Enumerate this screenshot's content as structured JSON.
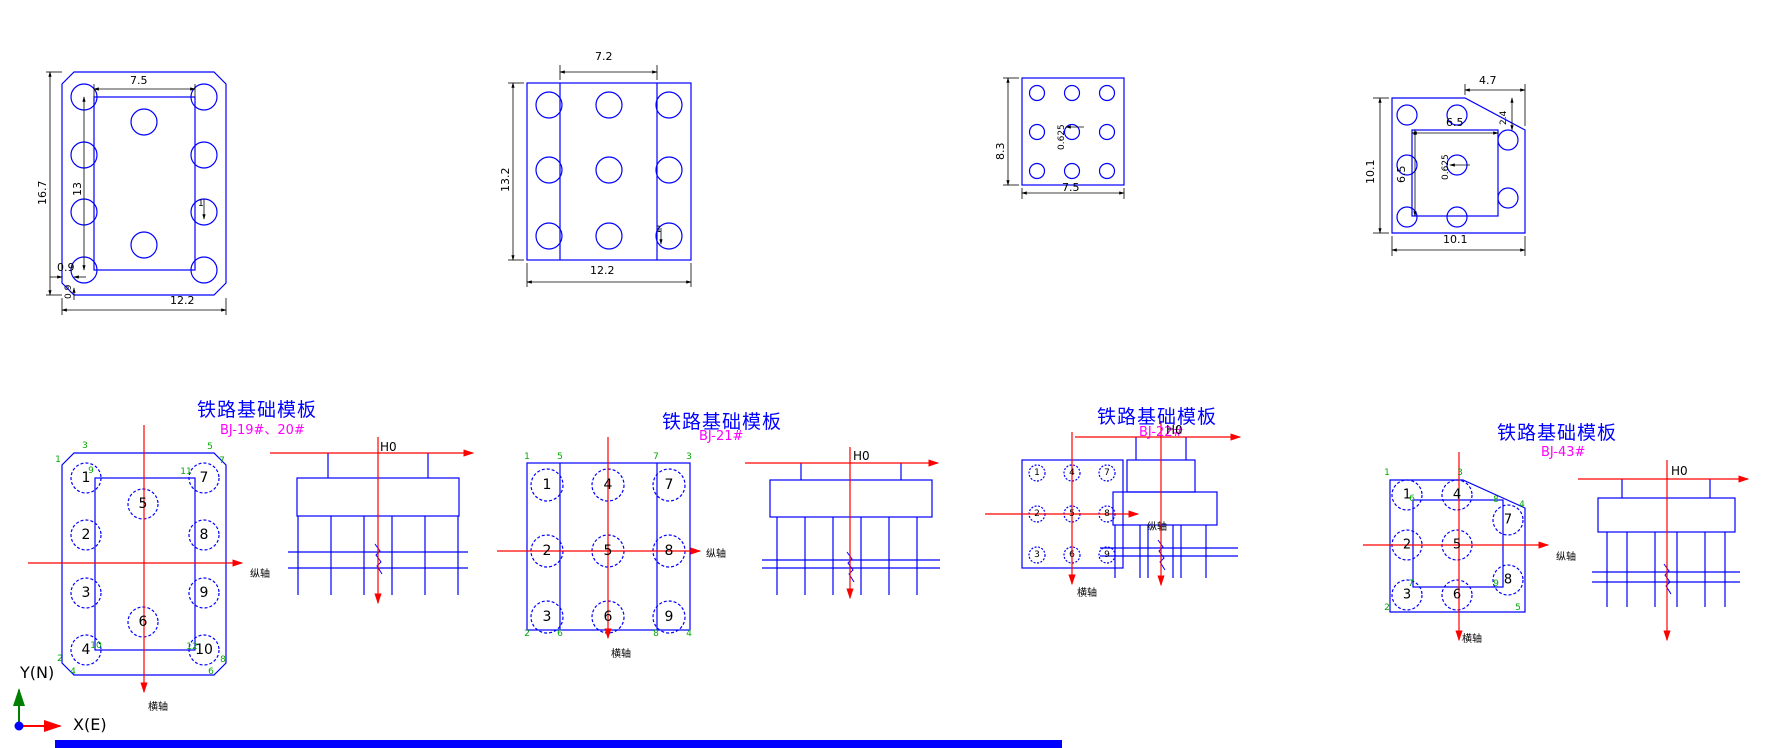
{
  "colors": {
    "geometry": "#0000ff",
    "axis": "#ff0000",
    "dimension": "#000000",
    "node_number": "#00aa00",
    "title": "#0000ff",
    "subtitle": "#ff00ff",
    "ucs_y_arrow": "#008000",
    "ucs_x_arrow": "#ff0000"
  },
  "top_drawings": {
    "footing_a": {
      "dim_inner_width": "7.5",
      "dim_height": "16.7",
      "dim_inner_height": "13",
      "dim_width": "12.2",
      "dim_chamfer_h": "0.9",
      "dim_chamfer_v": "0.9",
      "dim_pile": "1"
    },
    "footing_b": {
      "dim_inner_width": "7.2",
      "dim_height": "13.2",
      "dim_width": "12.2",
      "dim_pile": "1"
    },
    "footing_c": {
      "dim_height": "8.3",
      "dim_width": "7.5",
      "dim_pile": "0.625"
    },
    "footing_d": {
      "dim_chamfer_w": "4.7",
      "dim_chamfer_h": "2.4",
      "dim_inner_width": "6.5",
      "dim_inner_height": "6.5",
      "dim_height": "10.1",
      "dim_width": "10.1",
      "dim_pile": "0.625"
    }
  },
  "templates": [
    {
      "title": "铁路基础模板",
      "subtitle": "BJ-19#、20#",
      "elevation_mark": "H0",
      "axis_longitudinal": "纵轴",
      "axis_transverse": "横轴",
      "pile_numbers": [
        {
          "t": "1",
          "x": 86,
          "y": 478
        },
        {
          "t": "2",
          "x": 86,
          "y": 535
        },
        {
          "t": "3",
          "x": 86,
          "y": 593
        },
        {
          "t": "4",
          "x": 86,
          "y": 650
        },
        {
          "t": "5",
          "x": 143,
          "y": 504
        },
        {
          "t": "6",
          "x": 143,
          "y": 622
        },
        {
          "t": "7",
          "x": 204,
          "y": 478
        },
        {
          "t": "8",
          "x": 204,
          "y": 535
        },
        {
          "t": "9",
          "x": 204,
          "y": 593
        },
        {
          "t": "10",
          "x": 204,
          "y": 650
        }
      ],
      "node_numbers": [
        {
          "t": "3",
          "x": 85,
          "y": 446
        },
        {
          "t": "5",
          "x": 210,
          "y": 447
        },
        {
          "t": "1",
          "x": 58,
          "y": 460
        },
        {
          "t": "7",
          "x": 222,
          "y": 461
        },
        {
          "t": "9",
          "x": 91,
          "y": 471
        },
        {
          "t": "11",
          "x": 186,
          "y": 472
        },
        {
          "t": "10",
          "x": 96,
          "y": 646
        },
        {
          "t": "12",
          "x": 192,
          "y": 647
        },
        {
          "t": "2",
          "x": 60,
          "y": 659
        },
        {
          "t": "8",
          "x": 223,
          "y": 660
        },
        {
          "t": "4",
          "x": 73,
          "y": 672
        },
        {
          "t": "6",
          "x": 211,
          "y": 672
        }
      ]
    },
    {
      "title": "铁路基础模板",
      "subtitle": "BJ-21#",
      "elevation_mark": "H0",
      "axis_longitudinal": "纵轴",
      "axis_transverse": "横轴",
      "pile_numbers": [
        {
          "t": "1",
          "x": 547,
          "y": 485
        },
        {
          "t": "2",
          "x": 547,
          "y": 551
        },
        {
          "t": "3",
          "x": 547,
          "y": 617
        },
        {
          "t": "4",
          "x": 608,
          "y": 485
        },
        {
          "t": "5",
          "x": 608,
          "y": 551
        },
        {
          "t": "6",
          "x": 608,
          "y": 617
        },
        {
          "t": "7",
          "x": 669,
          "y": 485
        },
        {
          "t": "8",
          "x": 669,
          "y": 551
        },
        {
          "t": "9",
          "x": 669,
          "y": 617
        }
      ],
      "node_numbers": [
        {
          "t": "1",
          "x": 527,
          "y": 457
        },
        {
          "t": "5",
          "x": 560,
          "y": 457
        },
        {
          "t": "7",
          "x": 656,
          "y": 457
        },
        {
          "t": "3",
          "x": 689,
          "y": 457
        },
        {
          "t": "2",
          "x": 527,
          "y": 634
        },
        {
          "t": "6",
          "x": 560,
          "y": 634
        },
        {
          "t": "8",
          "x": 656,
          "y": 634
        },
        {
          "t": "4",
          "x": 689,
          "y": 634
        }
      ]
    },
    {
      "title": "铁路基础模板",
      "subtitle": "BJ-22#",
      "elevation_mark": "H0",
      "axis_longitudinal": "纵轴",
      "axis_transverse": "横轴",
      "pile_numbers": [
        {
          "t": "1",
          "x": 1037,
          "y": 473
        },
        {
          "t": "2",
          "x": 1037,
          "y": 514
        },
        {
          "t": "3",
          "x": 1037,
          "y": 555
        },
        {
          "t": "4",
          "x": 1072,
          "y": 473
        },
        {
          "t": "5",
          "x": 1072,
          "y": 514
        },
        {
          "t": "6",
          "x": 1072,
          "y": 555
        },
        {
          "t": "7",
          "x": 1107,
          "y": 473
        },
        {
          "t": "8",
          "x": 1107,
          "y": 514
        },
        {
          "t": "9",
          "x": 1107,
          "y": 555
        }
      ],
      "node_numbers": []
    },
    {
      "title": "铁路基础模板",
      "subtitle": "BJ-43#",
      "elevation_mark": "H0",
      "axis_longitudinal": "纵轴",
      "axis_transverse": "横轴",
      "pile_numbers": [
        {
          "t": "1",
          "x": 1407,
          "y": 495
        },
        {
          "t": "2",
          "x": 1407,
          "y": 545
        },
        {
          "t": "3",
          "x": 1407,
          "y": 595
        },
        {
          "t": "4",
          "x": 1457,
          "y": 495
        },
        {
          "t": "5",
          "x": 1457,
          "y": 545
        },
        {
          "t": "6",
          "x": 1457,
          "y": 595
        },
        {
          "t": "7",
          "x": 1508,
          "y": 520
        },
        {
          "t": "8",
          "x": 1508,
          "y": 580
        }
      ],
      "node_numbers": [
        {
          "t": "1",
          "x": 1387,
          "y": 473
        },
        {
          "t": "3",
          "x": 1460,
          "y": 473
        },
        {
          "t": "4",
          "x": 1522,
          "y": 505
        },
        {
          "t": "6",
          "x": 1412,
          "y": 499
        },
        {
          "t": "8",
          "x": 1496,
          "y": 500
        },
        {
          "t": "7",
          "x": 1411,
          "y": 584
        },
        {
          "t": "9",
          "x": 1496,
          "y": 584
        },
        {
          "t": "2",
          "x": 1387,
          "y": 608
        },
        {
          "t": "5",
          "x": 1518,
          "y": 608
        }
      ]
    }
  ],
  "ucs": {
    "y_label": "Y(N)",
    "x_label": "X(E)"
  }
}
